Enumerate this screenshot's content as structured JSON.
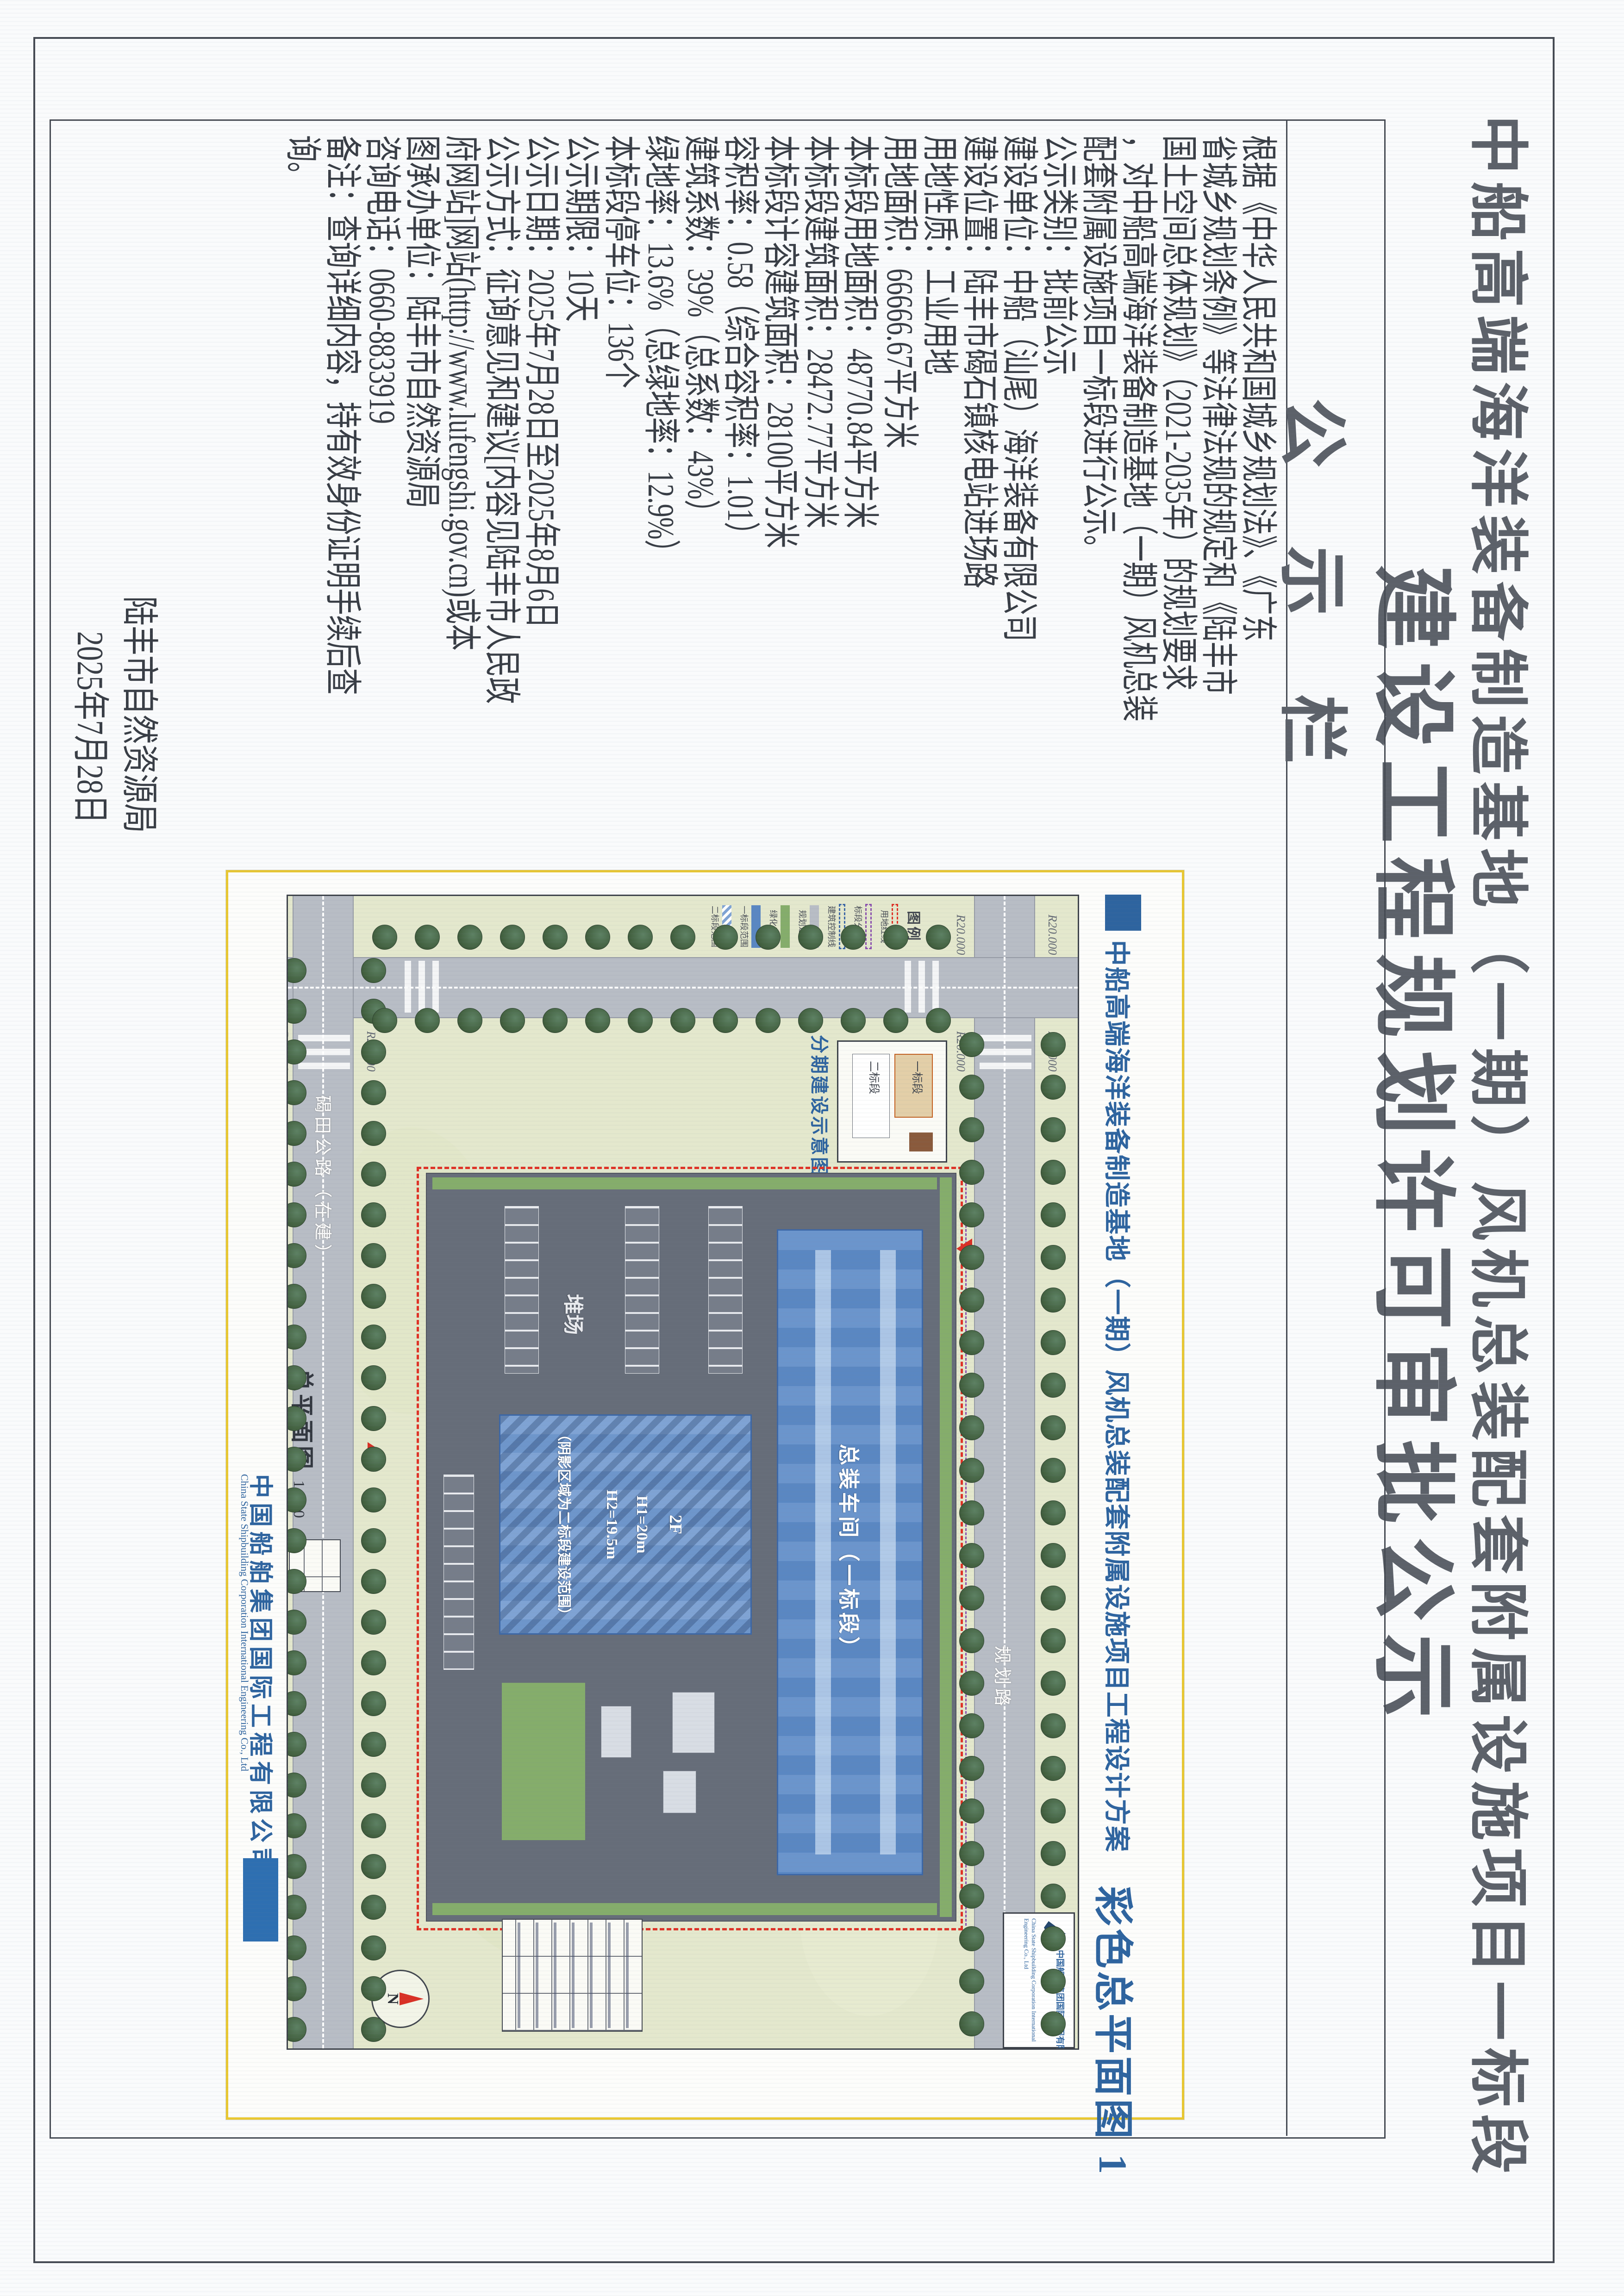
{
  "page": {
    "title_line1": "中船高端海洋装备制造基地（一期）风机总装配套附属设施项目一标段",
    "title_line2": "建设工程规划许可审批公示",
    "board_label": "公示栏"
  },
  "notice": {
    "lines": [
      "根据《中华人民共和国城乡规划法》、《广东",
      "省城乡规划条例》等法律法规的规定和《陆丰市",
      "国土空间总体规划》（2021-2035年）的规划要求",
      "，对中船高端海洋装备制造基地（一期）风机总装",
      "配套附属设施项目一标段进行公示。",
      "公示类别：批前公示",
      "建设单位：中船（汕尾）海洋装备有限公司",
      "建设位置：陆丰市碣石镇核电站进场路",
      "用地性质：工业用地",
      "用地面积：66666.67平方米",
      "本标段用地面积：48770.84平方米",
      "本标段建筑面积：28472.77平方米",
      "本标段计容建筑面积：28100平方米",
      "容积率：0.58（综合容积率：1.01）",
      "建筑系数：39%（总系数：43%）",
      "绿地率：13.6%（总绿地率：12.9%）",
      "本标段停车位：136个",
      "公示期限：10天",
      "公示日期：2025年7月28日至2025年8月6日",
      "公示方式：征询意见和建议[内容见陆丰市人民政",
      "府网站]网站(http://www.lufengshi.gov.cn)或本",
      "图承办单位：陆丰市自然资源局",
      "咨询电话：0660-8833919",
      "备注：查询详细内容，持有效身份证明手续后查",
      "询。"
    ],
    "signature_org": "陆丰市自然资源局",
    "signature_date": "2025年7月28日"
  },
  "sheet": {
    "header_title": "中船高端海洋装备制造基地（一期）风机总装配套附属设施项目工程设计方案",
    "sheet_name": "彩色总平面图 1",
    "caption_main": "总平面图",
    "caption_scale": "1:500",
    "company_cn": "中国船舶集团国际工程有限公司",
    "company_en": "China State Shipbuilding Corporation International Engineering Co., Ltd",
    "road_top_label": "规划路",
    "road_bottom_label": "碣田公路（在建）",
    "radius_label": "R20.000",
    "site": {
      "building_a_label": "总装车间（一标段）",
      "building_b_lines": [
        "2F",
        "H1=20m",
        "H2=19.5m"
      ],
      "building_b_note": "（阴影区域为二标段建设范围）",
      "yard_label": "堆场"
    },
    "phasing_inset": {
      "label": "分期建设示意图",
      "zone_a": "一标段",
      "zone_b": "二标段"
    },
    "legend": {
      "title": "图例",
      "items": [
        {
          "label": "用地红线",
          "color": "#e03226",
          "style": "dashed"
        },
        {
          "label": "标段分界线",
          "color": "#8a4fae",
          "style": "dashed"
        },
        {
          "label": "建筑控制线",
          "color": "#3c67a6",
          "style": "dashed"
        },
        {
          "label": "规划道路",
          "color": "#b8bdc5",
          "style": "solid"
        },
        {
          "label": "绿化用地",
          "color": "#85ad6b",
          "style": "solid"
        },
        {
          "label": "一标段范围",
          "color": "#5a87c2",
          "style": "solid"
        },
        {
          "label": "二标段范围",
          "color": "#7fa3d4",
          "style": "hatch"
        }
      ]
    },
    "compass_label": "N"
  },
  "colors": {
    "accent_blue": "#2e649f",
    "sheet_border_yellow": "#e9c832",
    "boundary_red": "#e03226",
    "divider_purple": "#8a4fae",
    "field_green": "#e4e8cd",
    "roof_blue": "#5a87c2"
  }
}
